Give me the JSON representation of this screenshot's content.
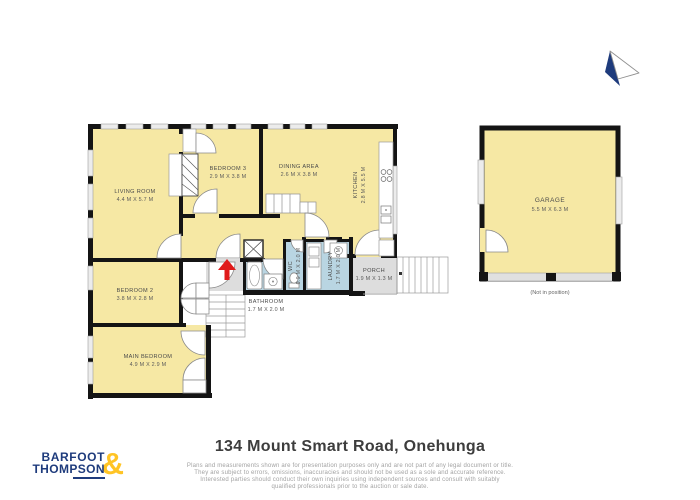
{
  "footer": {
    "address": "134 Mount Smart Road, Onehunga",
    "disclaimer_lines": [
      "Plans and measurements shown are for presentation purposes only and are not part of any legal document or title.",
      "They are subject to errors, omissions, inaccuracies and should not be used as a sole and accurate reference.",
      "Interested parties should conduct their own inquiries using independent sources and consult with suitably",
      "qualified professionals prior to the auction or sale date."
    ]
  },
  "logo": {
    "line1": "BARFOOT",
    "line2": "THOMPSON",
    "ampersand": "&",
    "navy": "#1e3b7c",
    "yellow": "#ffc425"
  },
  "palette": {
    "floor_yellow": "#f6e8a4",
    "wet_blue": "#b9d5e2",
    "outdoor_grey": "#dddddd",
    "wall_black": "#141414",
    "arrow_red": "#e01b1b"
  },
  "rooms": {
    "living": {
      "name": "LIVING ROOM",
      "dims": "4.4 M X 5.7 M"
    },
    "bedroom3": {
      "name": "BEDROOM 3",
      "dims": "2.9 M X 3.8 M"
    },
    "dining": {
      "name": "DINING AREA",
      "dims": "2.6 M X 3.8 M"
    },
    "kitchen": {
      "name": "KITCHEN",
      "dims": "2.8 M X 5.5 M"
    },
    "bedroom2": {
      "name": "BEDROOM 2",
      "dims": "3.8 M X 2.8 M"
    },
    "main_bedroom": {
      "name": "MAIN BEDROOM",
      "dims": "4.9 M X 2.9 M"
    },
    "bathroom": {
      "name": "BATHROOM",
      "dims": "1.7 M X 2.0 M"
    },
    "wc": {
      "name": "WC",
      "dims": "0.9 M X 2.0 M"
    },
    "laundry": {
      "name": "LAUNDRY",
      "dims": "1.7 M X 2.0 M"
    },
    "porch": {
      "name": "PORCH",
      "dims": "1.9 M X 1.3 M"
    },
    "garage": {
      "name": "GARAGE",
      "dims": "5.5 M X 6.3 M",
      "note": "(Not in position)"
    }
  }
}
